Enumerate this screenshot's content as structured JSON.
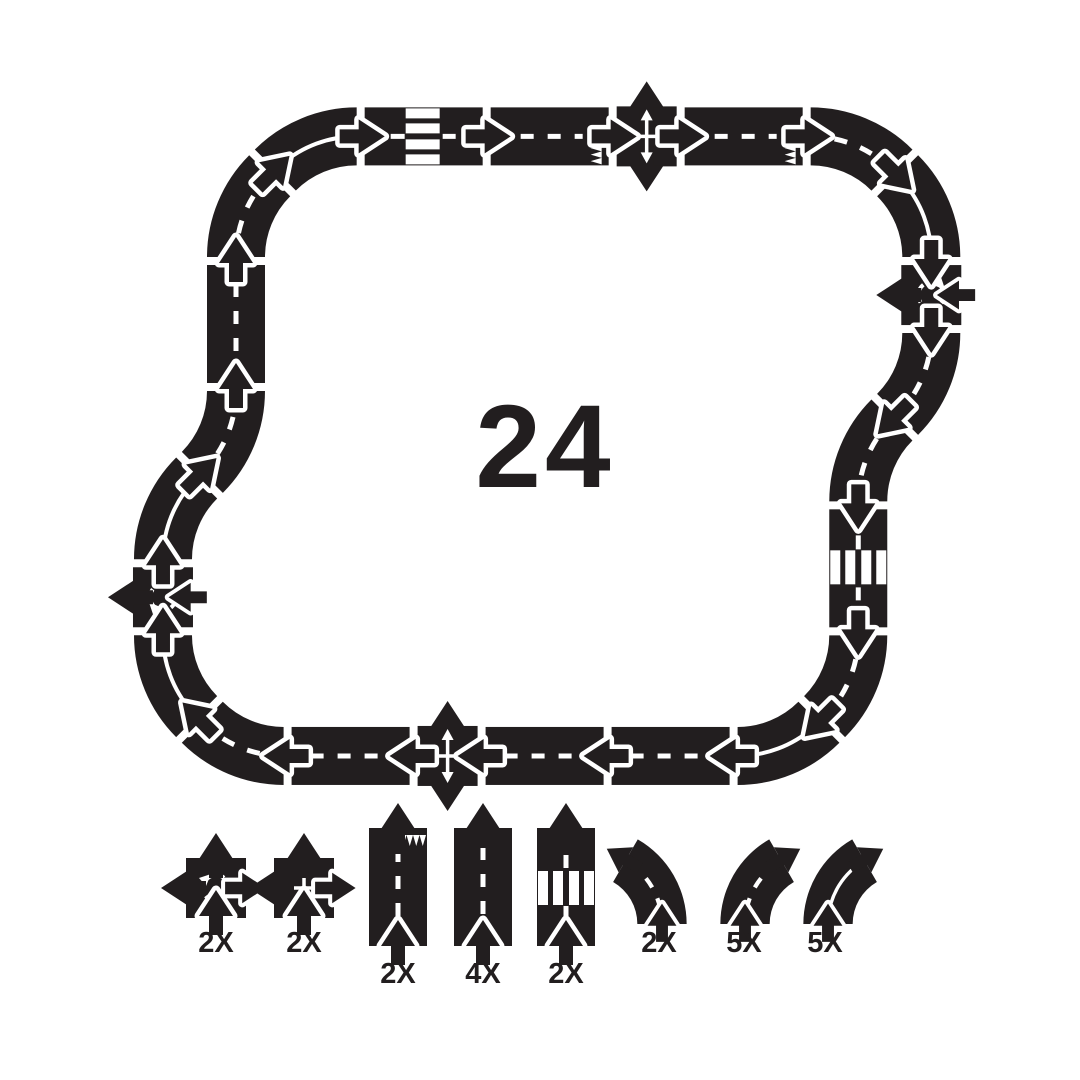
{
  "set_total_label": "24",
  "colors": {
    "piece_black": "#221e1f",
    "marking_white": "#ffffff",
    "background": "#ffffff"
  },
  "track": {
    "description": "closed loop of 24 interlocking road pieces with arrow connectors",
    "pieces": [
      "straight",
      "curve",
      "curve-solid",
      "zebra",
      "dead-end",
      "intersection",
      "dead-end",
      "curve",
      "curve-solid",
      "roundabout",
      "curve",
      "curve-left",
      "zebra",
      "curve",
      "curve-solid",
      "straight",
      "straight",
      "intersection",
      "straight",
      "curve",
      "curve-solid",
      "roundabout-mirrored",
      "curve-solid",
      "curve-left"
    ]
  },
  "legend": {
    "items": [
      {
        "type": "roundabout",
        "count_label": "2X"
      },
      {
        "type": "intersection",
        "count_label": "2X"
      },
      {
        "type": "dead-end-straight",
        "count_label": "2X"
      },
      {
        "type": "straight",
        "count_label": "4X"
      },
      {
        "type": "crosswalk-straight",
        "count_label": "2X"
      },
      {
        "type": "curve-left",
        "count_label": "2X"
      },
      {
        "type": "curve-dashed",
        "count_label": "5X"
      },
      {
        "type": "curve-solid-line",
        "count_label": "5X"
      }
    ]
  }
}
